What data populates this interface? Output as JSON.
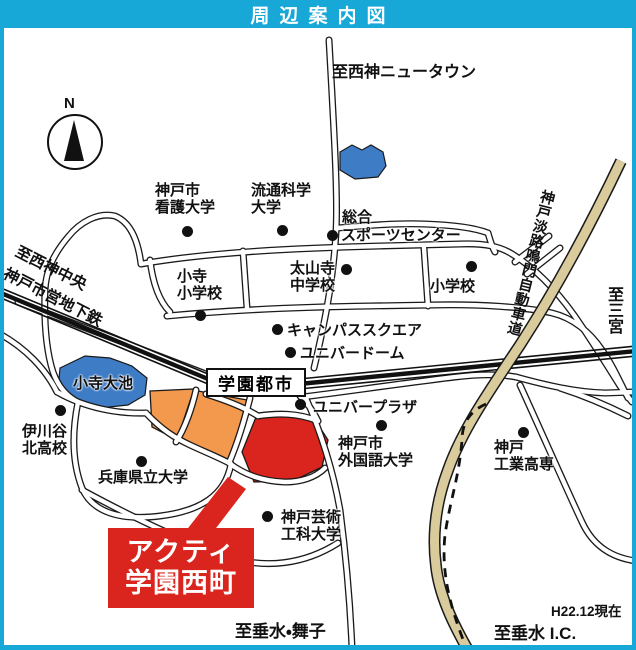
{
  "banner": {
    "title": "周辺案内図"
  },
  "colors": {
    "banner_cyan": "#18A8D8",
    "area_red": "#D9251D",
    "area_orange": "#F2994E",
    "pond_blue": "#3E7CC6",
    "highway_tan": "#DACB9D"
  },
  "compass": {
    "north": "N"
  },
  "station": {
    "name": "学園都市"
  },
  "callout": {
    "name": "アクティ\n学園西町"
  },
  "directions": {
    "nishikobe_newtown": "至西神ニュータウン",
    "seishin_chuo": "至西神中央",
    "subway_line": "神戸市営地下鉄",
    "sannomiya": "至三宮",
    "highway": "神戸淡路鳴門自動車道",
    "tarumi_maiko": "至垂水・舞子",
    "tarumi_ic": "至垂水 I.C.",
    "as_of": "H22.12現在"
  },
  "pois": {
    "kobe_nursing_univ": "神戸市\n看護大学",
    "ryutsu_kagaku_univ": "流通科学\n大学",
    "sports_center_line1": "総合",
    "sports_center_line2": "スポーツセンター",
    "kodera_elementary": "小寺\n小学校",
    "taisanji_junior_high": "太山寺\n中学校",
    "elementary_school": "小学校",
    "campus_square": "キャンパススクエア",
    "univer_dome": "ユニバードーム",
    "univer_plaza": "ユニバープラザ",
    "kodera_oike_pond": "小寺大池",
    "ikawadani_kita_high": "伊川谷\n北高校",
    "hyogo_pref_univ": "兵庫県立大学",
    "kobe_gaidai_univ": "神戸市\n外国語大学",
    "kobe_design_univ": "神戸芸術\n工科大学",
    "kobe_kosen": "神戸\n工業高専"
  }
}
